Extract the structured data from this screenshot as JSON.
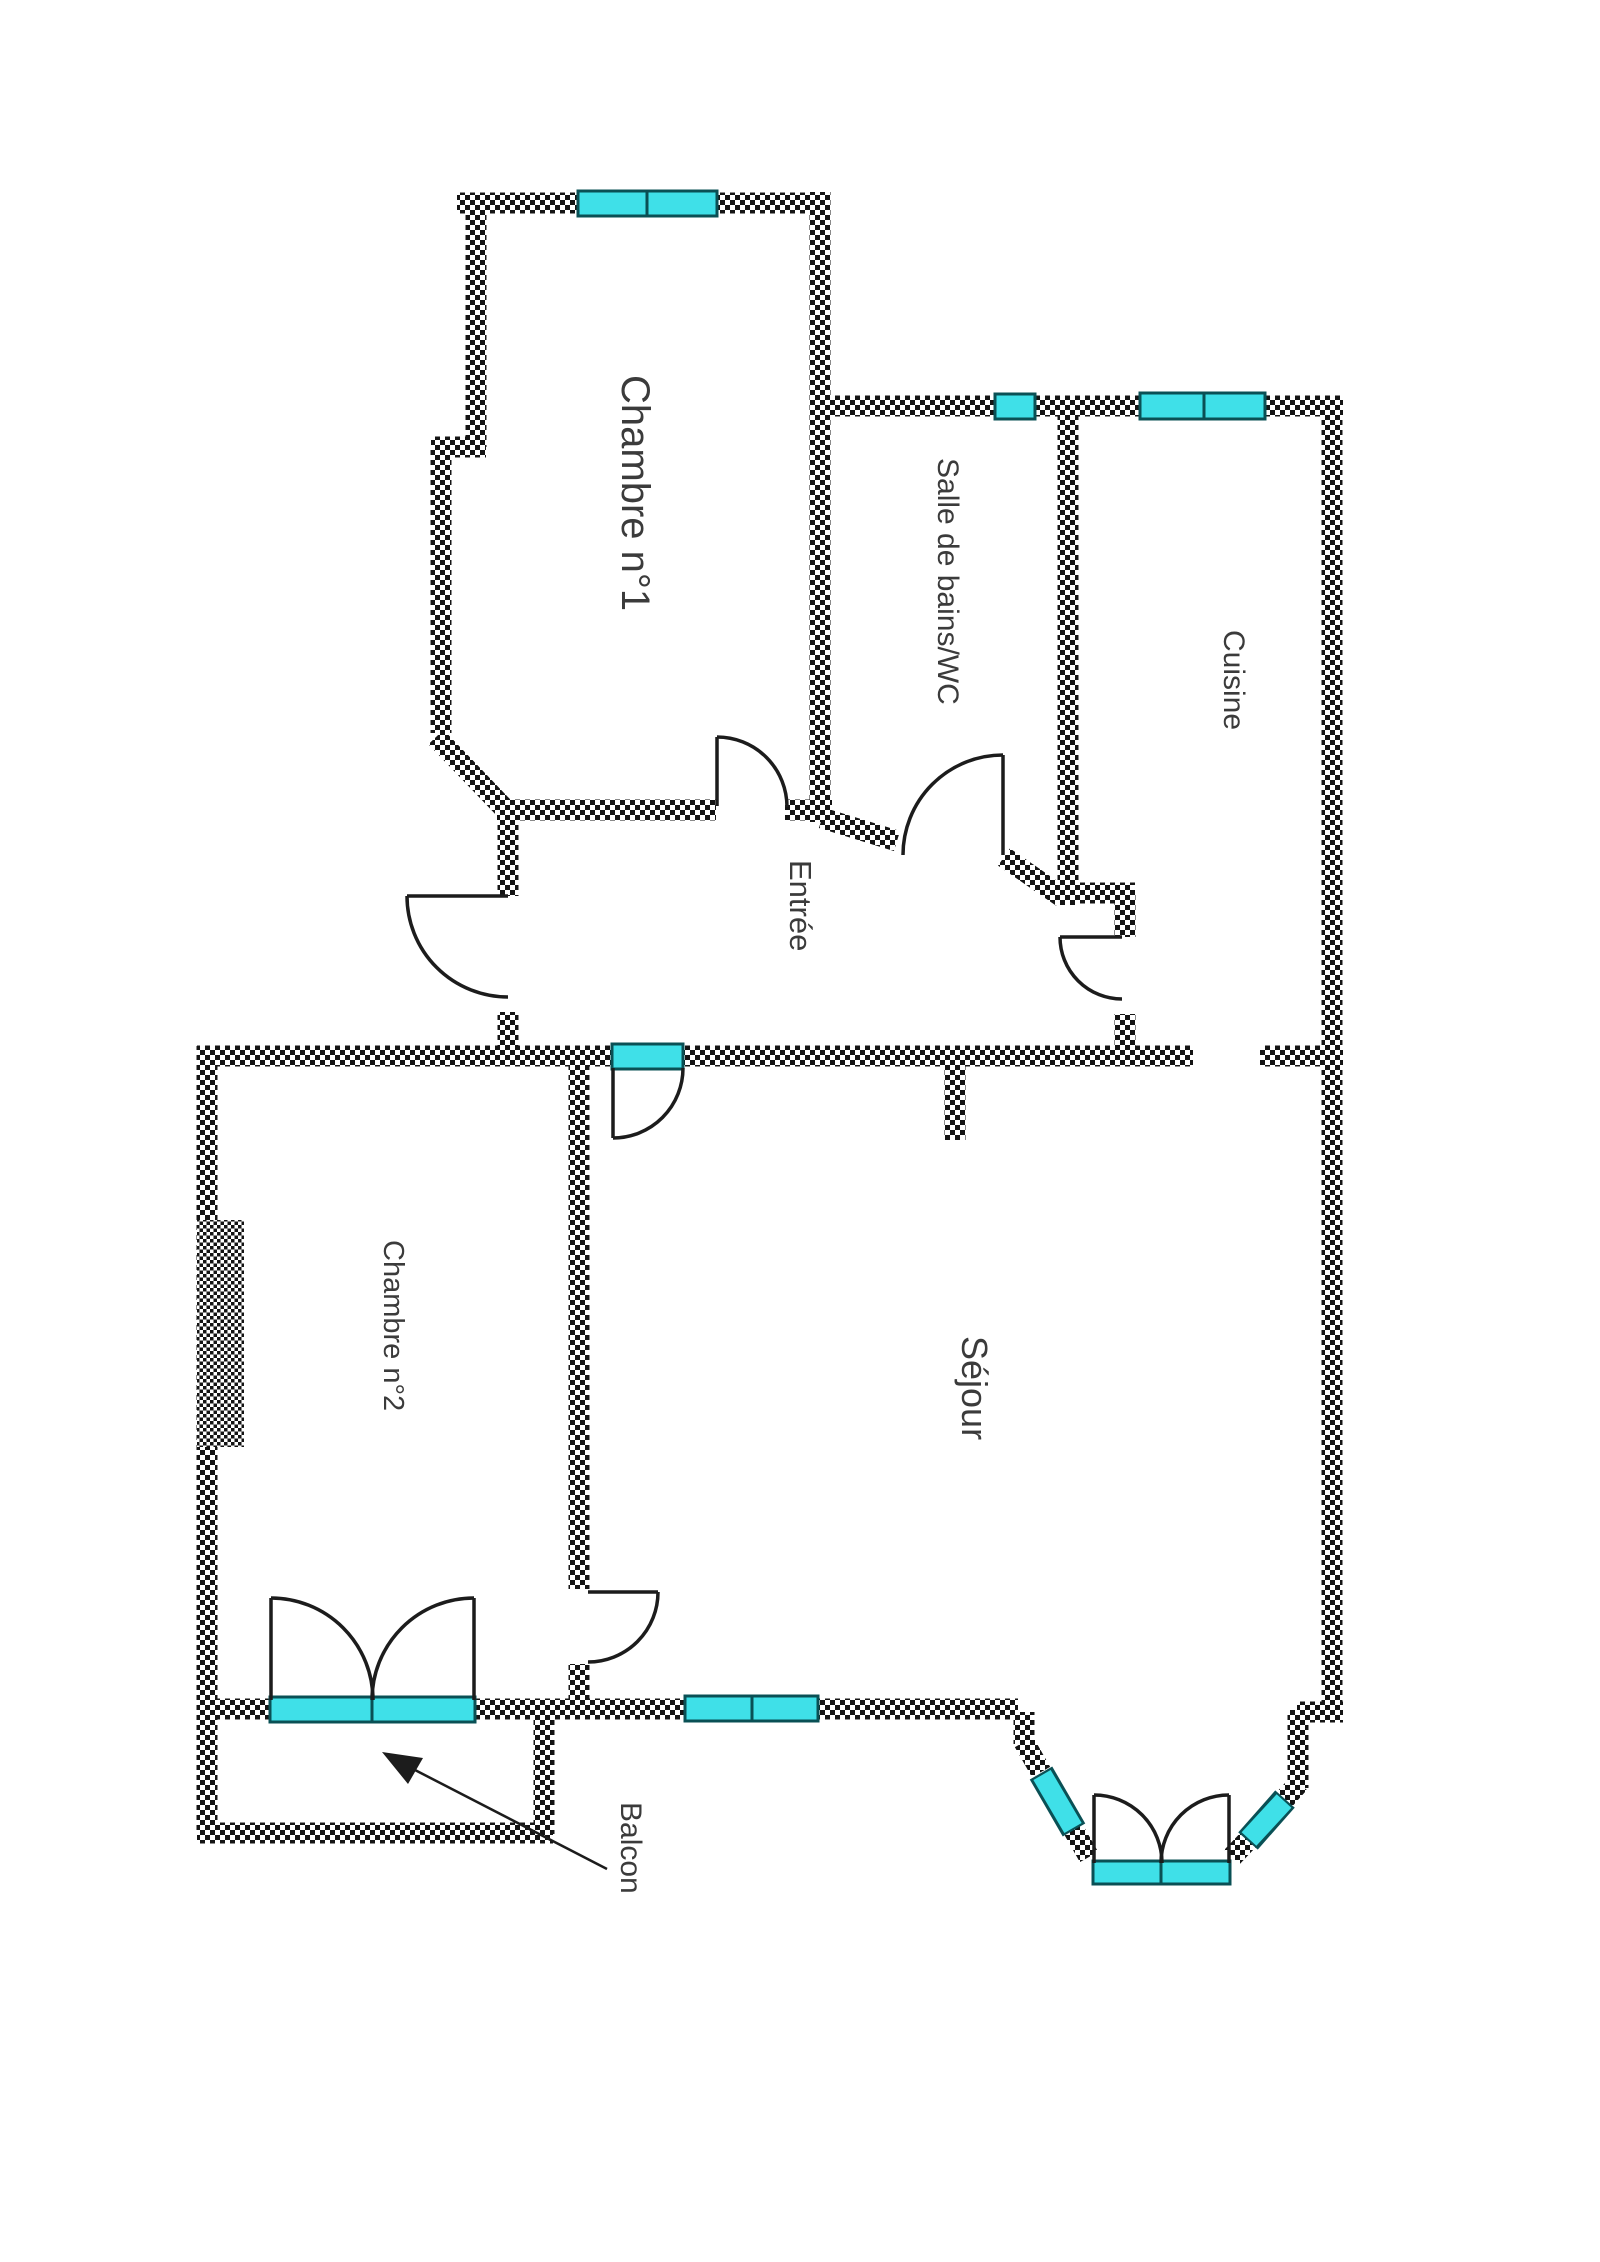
{
  "plan": {
    "type": "apartment-floor-plan",
    "rooms": [
      {
        "id": "chambre1",
        "label": "Chambre n°1"
      },
      {
        "id": "salle-de-bains-wc",
        "label": "Salle de bains/WC"
      },
      {
        "id": "cuisine",
        "label": "Cuisine"
      },
      {
        "id": "entree",
        "label": "Entrée"
      },
      {
        "id": "chambre2",
        "label": "Chambre n°2"
      },
      {
        "id": "sejour",
        "label": "Séjour"
      },
      {
        "id": "balcon",
        "label": "Balcon"
      }
    ],
    "colors": {
      "window-fill": "#3fe0e8",
      "window-stroke": "#0a5055",
      "wall-ink": "#141414",
      "line-ink": "#1c1c1c",
      "label-ink": "#3b3b3b"
    }
  }
}
